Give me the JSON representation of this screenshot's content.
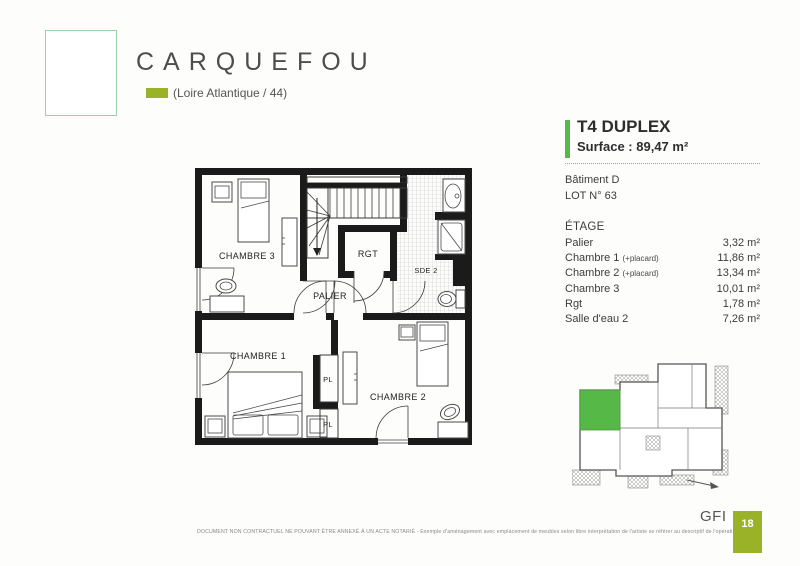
{
  "header": {
    "city": "CARQUEFOU",
    "department": "(Loire Atlantique / 44)"
  },
  "unit": {
    "type": "T4 DUPLEX",
    "surface": "Surface : 89,47 m²",
    "building": "Bâtiment D",
    "lot": "LOT N° 63"
  },
  "areas": {
    "level": "ÉTAGE",
    "rooms": [
      {
        "name": "Palier",
        "suffix": "",
        "area": "3,32 m²"
      },
      {
        "name": "Chambre 1",
        "suffix": "(+placard)",
        "area": "11,86 m²"
      },
      {
        "name": "Chambre 2",
        "suffix": "(+placard)",
        "area": "13,34 m²"
      },
      {
        "name": "Chambre 3",
        "suffix": "",
        "area": "10,01 m²"
      },
      {
        "name": "Rgt",
        "suffix": "",
        "area": "1,78 m²"
      },
      {
        "name": "Salle d'eau 2",
        "suffix": "",
        "area": "7,26 m²"
      }
    ]
  },
  "plan_labels": {
    "chambre3": "CHAMBRE 3",
    "rgt": "RGT",
    "sde2": "SDE 2",
    "palier": "PALIER",
    "chambre1": "CHAMBRE 1",
    "pl_top": "PL",
    "pl_bottom": "PL",
    "chambre2": "CHAMBRE 2"
  },
  "footer": {
    "disclaimer": "DOCUMENT NON CONTRACTUEL NE POUVANT ÊTRE ANNEXÉ À UN ACTE NOTARIÉ - Exemple d'aménagement avec emplacement de meubles selon libre interprétation de l'artiste se référer au descriptif de l'opération",
    "brand": "GFI",
    "page_number": "18"
  },
  "colors": {
    "accent_green": "#56b947",
    "olive_green": "#9ab227",
    "logo_border": "#9ccfae"
  }
}
